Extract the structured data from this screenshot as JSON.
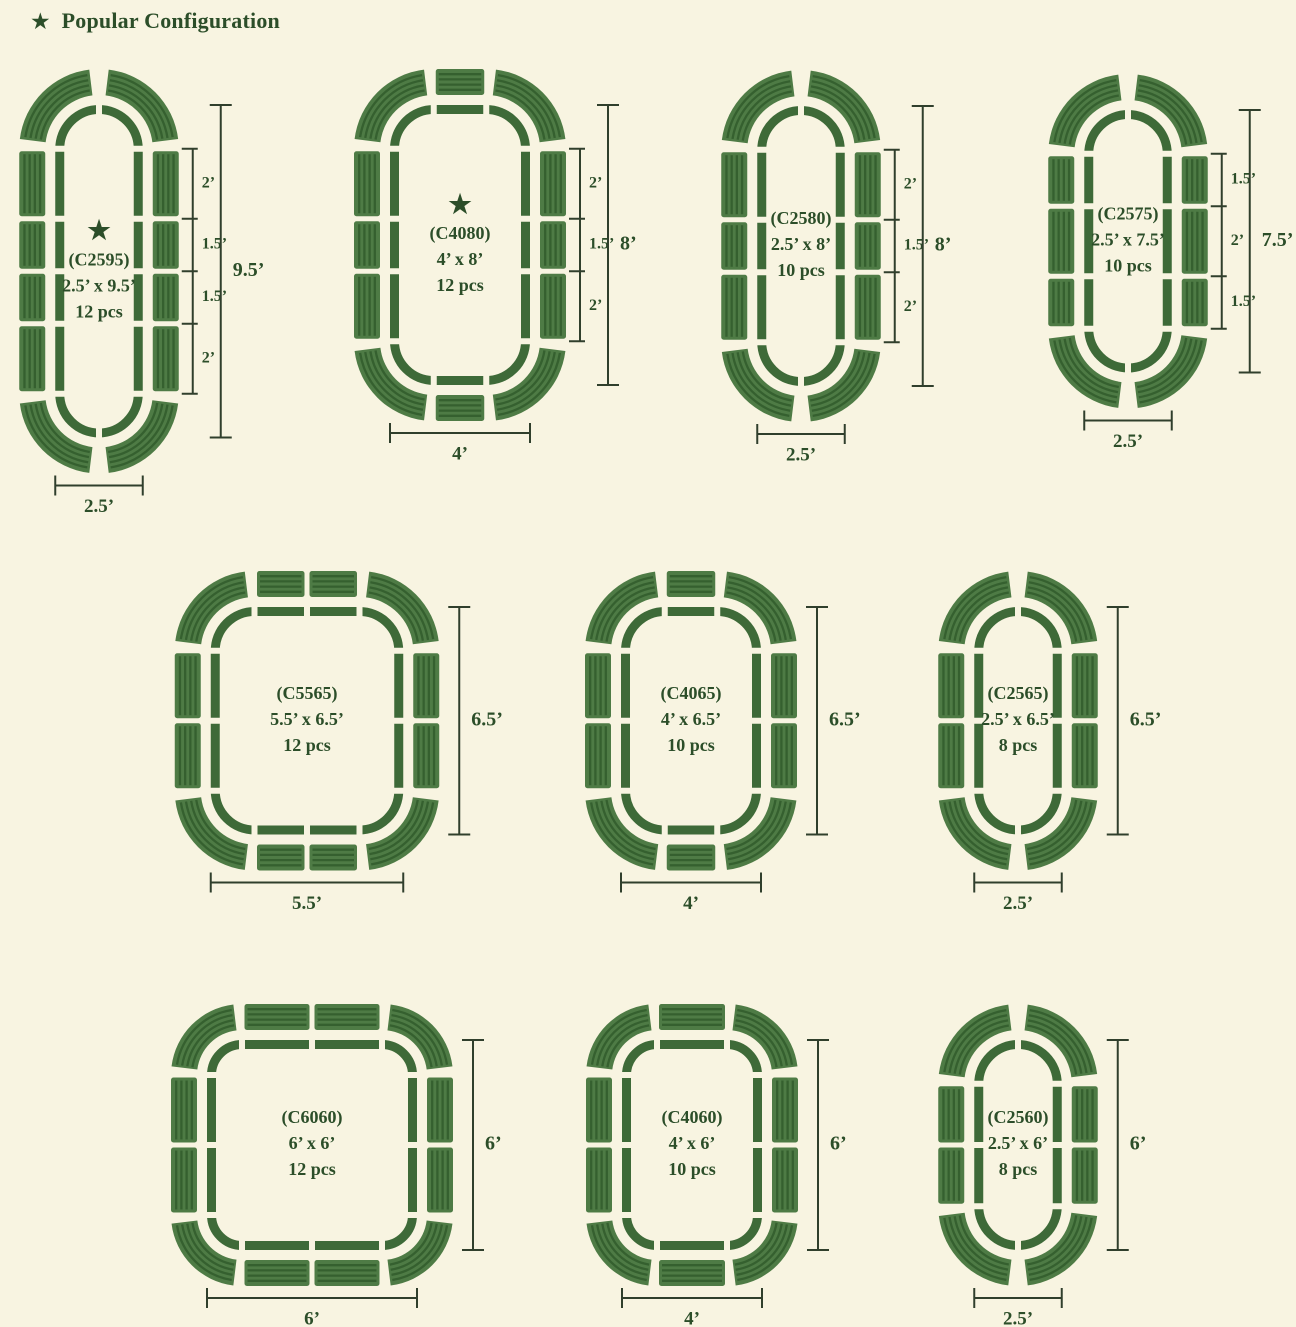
{
  "header": {
    "title": "Popular Configuration"
  },
  "icons": {
    "star": "★"
  },
  "colors": {
    "background": "#f8f4e1",
    "rail": "#3e6a38",
    "panel": "#4e7b45",
    "panel_stripe": "#35602f",
    "text": "#2c4e29",
    "ruler": "#303f2c"
  },
  "configs": [
    {
      "code": "(C2595)",
      "size": "2.5’ x 9.5’",
      "pieces": "12 pcs",
      "popular": true,
      "bed_w_ft": 2.5,
      "bed_h_ft": 9.5,
      "side_panels_ft": [
        2,
        1.5,
        1.5,
        2
      ],
      "top_panel_count": 0,
      "segment_labels": [
        "2’",
        "1.5’",
        "1.5’",
        "2’"
      ],
      "height_label": "9.5’",
      "width_label": "2.5’"
    },
    {
      "code": "(C4080)",
      "size": "4’ x 8’",
      "pieces": "12 pcs",
      "popular": true,
      "bed_w_ft": 4,
      "bed_h_ft": 8,
      "side_panels_ft": [
        2,
        1.5,
        2
      ],
      "top_panel_count": 1,
      "segment_labels": [
        "2’",
        "1.5’",
        "2’"
      ],
      "height_label": "8’",
      "width_label": "4’"
    },
    {
      "code": "(C2580)",
      "size": "2.5’ x 8’",
      "pieces": "10 pcs",
      "popular": false,
      "bed_w_ft": 2.5,
      "bed_h_ft": 8,
      "side_panels_ft": [
        2,
        1.5,
        2
      ],
      "top_panel_count": 0,
      "segment_labels": [
        "2’",
        "1.5’",
        "2’"
      ],
      "height_label": "8’",
      "width_label": "2.5’"
    },
    {
      "code": "(C2575)",
      "size": "2.5’ x 7.5’",
      "pieces": "10 pcs",
      "popular": false,
      "bed_w_ft": 2.5,
      "bed_h_ft": 7.5,
      "side_panels_ft": [
        1.5,
        2,
        1.5
      ],
      "top_panel_count": 0,
      "segment_labels": [
        "1.5’",
        "2’",
        "1.5’"
      ],
      "height_label": "7.5’",
      "width_label": "2.5’"
    },
    {
      "code": "(C5565)",
      "size": "5.5’ x 6.5’",
      "pieces": "12 pcs",
      "popular": false,
      "bed_w_ft": 5.5,
      "bed_h_ft": 6.5,
      "side_panels_ft": [
        2,
        2
      ],
      "top_panel_count": 2,
      "segment_labels": null,
      "height_label": "6.5’",
      "width_label": "5.5’"
    },
    {
      "code": "(C4065)",
      "size": "4’ x 6.5’",
      "pieces": "10 pcs",
      "popular": false,
      "bed_w_ft": 4,
      "bed_h_ft": 6.5,
      "side_panels_ft": [
        2,
        2
      ],
      "top_panel_count": 1,
      "segment_labels": null,
      "height_label": "6.5’",
      "width_label": "4’"
    },
    {
      "code": "(C2565)",
      "size": "2.5’ x 6.5’",
      "pieces": "8 pcs",
      "popular": false,
      "bed_w_ft": 2.5,
      "bed_h_ft": 6.5,
      "side_panels_ft": [
        2,
        2
      ],
      "top_panel_count": 0,
      "segment_labels": null,
      "height_label": "6.5’",
      "width_label": "2.5’"
    },
    {
      "code": "(C6060)",
      "size": "6’ x 6’",
      "pieces": "12 pcs",
      "popular": false,
      "bed_w_ft": 6,
      "bed_h_ft": 6,
      "side_panels_ft": [
        2,
        2
      ],
      "top_panel_count": 2,
      "segment_labels": null,
      "height_label": "6’",
      "width_label": "6’"
    },
    {
      "code": "(C4060)",
      "size": "4’ x 6’",
      "pieces": "10 pcs",
      "popular": false,
      "bed_w_ft": 4,
      "bed_h_ft": 6,
      "side_panels_ft": [
        2,
        2
      ],
      "top_panel_count": 1,
      "segment_labels": null,
      "height_label": "6’",
      "width_label": "4’"
    },
    {
      "code": "(C2560)",
      "size": "2.5’ x 6’",
      "pieces": "8 pcs",
      "popular": false,
      "bed_w_ft": 2.5,
      "bed_h_ft": 6,
      "side_panels_ft": [
        1.75,
        1.75
      ],
      "top_panel_count": 0,
      "segment_labels": null,
      "height_label": "6’",
      "width_label": "2.5’"
    }
  ]
}
